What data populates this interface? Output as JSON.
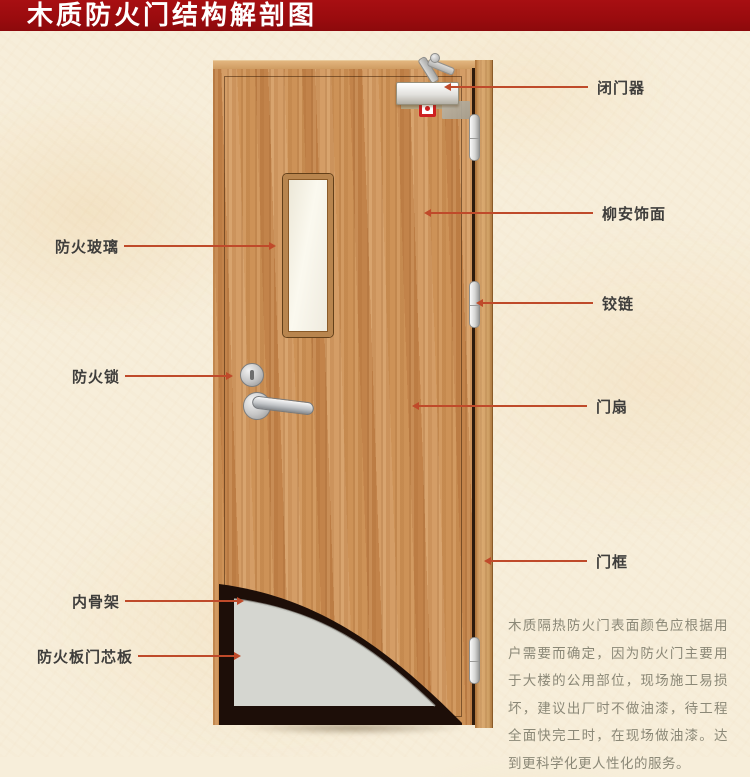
{
  "title": {
    "text": "木质防火门结构解剖图"
  },
  "callouts": {
    "left": [
      {
        "label": "防火玻璃",
        "target": "fire-rated-glass"
      },
      {
        "label": "防火锁",
        "target": "fire-lock"
      },
      {
        "label": "内骨架",
        "target": "inner-skeleton"
      },
      {
        "label": "防火板门芯板",
        "target": "fireproof-core-board"
      }
    ],
    "right": [
      {
        "label": "闭门器",
        "target": "door-closer"
      },
      {
        "label": "柳安饰面",
        "target": "lauan-veneer"
      },
      {
        "label": "铰链",
        "target": "hinge"
      },
      {
        "label": "门扇",
        "target": "door-leaf"
      },
      {
        "label": "门框",
        "target": "door-frame"
      }
    ]
  },
  "description": {
    "text": "木质隔热防火门表面颜色应根据用户需要而确定，因为防火门主要用于大楼的公用部位，现场施工易损坏，建议出厂时不做油漆，待工程全面快完工时，在现场做油漆。达到更科学化更人性化的服务。"
  },
  "colors": {
    "banner_red": "#9a0b0e",
    "leader_line": "#bf4a2a",
    "door_wood": "#c98c52",
    "frame_wood": "#cfa065",
    "core_gray": "#d5d6d0",
    "skeleton_dark": "#1d0e08",
    "background_cream": "#f7eeda"
  }
}
